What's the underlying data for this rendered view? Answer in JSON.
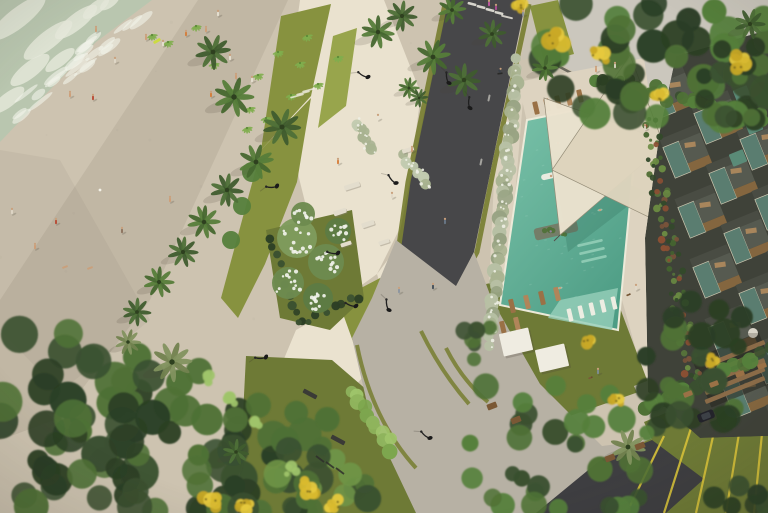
{
  "meta": {
    "title": "Aerial architectural rendering of a beachfront resort: beach with people, landscaped promenade with palms, road, swimming pool deck with shade sails and loungers, residential building with stepped balconies",
    "width": 768,
    "height": 513
  },
  "palette": {
    "sand": "#cdc3b0",
    "sandLight": "#d7cdbb",
    "shadow": "#6e6453",
    "sea": "#b7c6af",
    "foam": "#e6e9db",
    "plaza": "#eae2cf",
    "deck": "#ddd3c0",
    "concrete": "#b7b1a4",
    "gray": "#c9c2b3",
    "asphalt": "#474749",
    "asphaltB": "#3e3e41",
    "olive": "#7a8136",
    "lawn": "#87923f",
    "lawnBright": "#98a54c",
    "lawnDark": "#6e7a36",
    "leaf": "#4f7136",
    "leafLight": "#6f9447",
    "leafPale": "#9fc46a",
    "canopy": "#3a5030",
    "canopyDark": "#2c3f25",
    "yellow": "#d9ba2f",
    "white": "#f1eee4",
    "pool": "#7cc4ab",
    "poolDeep": "#4e9d85",
    "ledge": "#97d0ba",
    "sail": "#ece3cf",
    "sail2": "#ded4bd",
    "wood": "#9a7146",
    "woodDark": "#7a5835",
    "glass": "#5c8173",
    "slab": "#3f4239",
    "frame": "#d6d0b8",
    "hedge": "#a9b391",
    "hedgeDot": "#eef0e4",
    "skin": "#c9a07c",
    "lamp": "#1c1c1c",
    "roof": "#cbc7bd",
    "yellowLine": "#d8c23a"
  },
  "sea": {
    "poly": "0,0 152,0 96,42 44,96 0,142",
    "foam": [
      [
        18,
        18,
        34,
        10
      ],
      [
        48,
        40,
        30,
        9
      ],
      [
        76,
        22,
        26,
        8
      ],
      [
        30,
        70,
        24,
        8
      ],
      [
        8,
        100,
        20,
        7
      ],
      [
        60,
        60,
        18,
        6
      ],
      [
        96,
        8,
        16,
        6
      ],
      [
        110,
        2,
        12,
        5
      ]
    ]
  },
  "shadows": [
    {
      "p": "198,0 288,0 150,300 60,418 0,440 0,300",
      "o": 0.12
    },
    {
      "p": "0,150 60,160 150,320 60,392 0,330",
      "o": 0.08
    }
  ],
  "roof": {
    "p": "556,0 768,0 768,98 746,120 650,116 560,64",
    "parapet": "558,66 648,114 746,118 768,96"
  },
  "plaza": [
    {
      "p": "300,0 384,0 421,94 412,160 404,220 377,274 341,300 317,250 299,178 287,94",
      "f": "plaza"
    },
    {
      "p": "377,274 406,236 420,280 412,296 384,298",
      "f": "plaza"
    },
    {
      "p": "296,330 344,304 384,298 404,320 382,356 344,398 330,444 318,513 246,513 258,436 276,378",
      "f": "plaza"
    },
    {
      "p": "528,0 556,0 546,54 522,60",
      "f": "gray"
    },
    {
      "p": "518,82 644,58 650,100 527,122",
      "f": "deck"
    },
    {
      "p": "498,96 524,88 506,304 488,308",
      "f": "deck"
    },
    {
      "p": "636,94 668,88 698,384 650,400 622,300 630,180",
      "f": "deck"
    }
  ],
  "lawns": [
    {
      "p": "281,16 331,4 311,96 261,150",
      "f": "lawn"
    },
    {
      "p": "261,150 311,98 297,182 265,264 238,318 221,298",
      "f": "lawn"
    },
    {
      "p": "333,36 357,28 346,106 318,128",
      "f": "lawnBright"
    },
    {
      "p": "530,6 558,0 574,54 544,62",
      "f": "lawn"
    },
    {
      "p": "486,284 602,260 650,388 518,434",
      "f": "lawnDark"
    },
    {
      "p": "246,356 332,360 404,422 470,500 470,513 238,513",
      "f": "lawnDark"
    },
    {
      "p": "338,300 384,276 400,250 436,330 462,410 442,450 398,406 356,350",
      "f": "lawn"
    },
    {
      "p": "266,230 352,210 364,298 330,330 280,318",
      "f": "lawnDark"
    }
  ],
  "roads": {
    "asphalt": "448,0 526,0 492,164 474,252 456,288 410,294 396,252 410,180",
    "stripL": "445,4 408,182 398,252 408,290",
    "stripR": "529,4 495,162 477,252 458,288",
    "crosswalk": [
      [
        472,
        4
      ],
      [
        481,
        7
      ],
      [
        490,
        10
      ],
      [
        499,
        13
      ]
    ],
    "stopline": [
      507,
      17
    ],
    "dashes": [
      [
        497,
        32
      ],
      [
        489,
        98
      ],
      [
        481,
        162
      ]
    ],
    "junction": "396,240 456,286 474,252 492,300 540,384 602,446 650,440 600,462 540,513 416,513 370,416 352,338 372,298",
    "arcs": [
      "M446,348 Q462,380 488,402",
      "M421,331 Q441,372 469,404",
      "M357,345 Q372,420 416,468"
    ],
    "curb": "M600,462 L652,440",
    "asphaltB": "536,513 598,462 652,440 704,479 666,513",
    "parkSide": "634,386 768,334 768,366 648,418",
    "parkGreen": "644,422 768,370 768,513 664,513 652,440",
    "yellowLines": [
      [
        664,
        436,
        630,
        506
      ],
      [
        692,
        425,
        664,
        513
      ],
      [
        718,
        414,
        696,
        513
      ],
      [
        744,
        403,
        726,
        513
      ],
      [
        766,
        394,
        754,
        513
      ]
    ],
    "glyph": [
      [
        748,
        398,
        756,
        396
      ],
      [
        750,
        403,
        758,
        401
      ]
    ]
  },
  "pool": {
    "quad": "527,120 640,97 618,330 500,305",
    "ledge": "560,300 618,288 612,330 548,318",
    "steps": [
      [
        590,
        243
      ],
      [
        592,
        251
      ],
      [
        594,
        259
      ]
    ],
    "planters": [
      [
        570,
        162,
        36,
        11
      ],
      [
        556,
        230,
        44,
        12
      ]
    ],
    "swimmers": [
      [
        558,
        143
      ],
      [
        600,
        210
      ],
      [
        560,
        288
      ],
      [
        592,
        128
      ]
    ],
    "float": [
      549,
      176
    ],
    "sailShadow": "552,150 646,192 568,252",
    "inpool": [
      [
        570,
        315
      ],
      [
        581,
        312
      ],
      [
        592,
        309
      ],
      [
        603,
        306
      ],
      [
        614,
        303
      ]
    ],
    "topLoungers": [
      [
        536,
        108
      ],
      [
        547,
        105
      ],
      [
        558,
        102
      ],
      [
        569,
        99
      ],
      [
        580,
        96
      ]
    ],
    "southLoungers": [
      [
        512,
        306
      ],
      [
        527,
        302
      ],
      [
        542,
        298
      ],
      [
        557,
        294
      ],
      [
        503,
        328
      ],
      [
        517,
        324
      ]
    ],
    "daybeds": [
      [
        516,
        342
      ],
      [
        552,
        358
      ]
    ],
    "sails": [
      {
        "p": "544,98 668,142 560,235",
        "f": "sail"
      },
      {
        "p": "630,55 700,242 552,170",
        "f": "sail2"
      }
    ],
    "poleLines": [
      "M668,142 L676,136",
      "M560,235 L554,241",
      "M700,242 L708,238"
    ]
  },
  "building": {
    "clip": "676,56 768,30 768,436 700,438 648,392 645,238 660,130",
    "grid": {
      "x0": 652,
      "y0": 70,
      "cols": 3,
      "rows": 6,
      "cx": 46,
      "cy": 26,
      "rx": 15,
      "ry": 60,
      "rot": -22
    },
    "cubes": [
      [
        742,
        94
      ],
      [
        754,
        126
      ],
      [
        738,
        158
      ]
    ],
    "pergola": {
      "x": 698,
      "y": 342,
      "w": 72,
      "h": 52,
      "slats": 5,
      "rot": -22,
      "cx": 735,
      "cy": 370
    },
    "dome": [
      753,
      333
    ]
  },
  "gardenStrips": [
    {
      "x1": 648,
      "y1": 122,
      "x2": 692,
      "y2": 378,
      "n": 85,
      "r0": 1.5,
      "r1": 4,
      "jit": 9,
      "pal": [
        "#44632f",
        "#33492a",
        "#6a8a42",
        "#77523a",
        "#8a4f33",
        "#55713a"
      ]
    },
    {
      "x1": 600,
      "y1": 80,
      "x2": 764,
      "y2": 116,
      "n": 34,
      "r0": 3,
      "r1": 8,
      "jit": 7,
      "pal": [
        "#3a5030",
        "#4f7136",
        "#2c3f25",
        "#55803c"
      ]
    },
    {
      "x1": 644,
      "y1": 404,
      "x2": 768,
      "y2": 352,
      "n": 16,
      "r0": 5,
      "r1": 9,
      "jit": 5,
      "pal": [
        "#3a5030",
        "#4f7136",
        "#55803c"
      ]
    }
  ],
  "hedges": [
    {
      "x1": 517,
      "y1": 60,
      "x2": 489,
      "y2": 344,
      "n": 46,
      "r0": 5,
      "r1": 8,
      "jit": 3,
      "pal": [
        "#a9b391",
        "#98a383",
        "#b7c0a4"
      ],
      "dots": 40
    },
    {
      "x1": 355,
      "y1": 122,
      "x2": 372,
      "y2": 148,
      "n": 8,
      "r0": 4,
      "r1": 6,
      "jit": 3,
      "pal": [
        "#c2cbb0",
        "#a9b391"
      ],
      "dots": 10
    },
    {
      "x1": 402,
      "y1": 156,
      "x2": 428,
      "y2": 184,
      "n": 9,
      "r0": 4,
      "r1": 6,
      "jit": 3,
      "pal": [
        "#c2cbb0",
        "#a9b391"
      ],
      "dots": 10
    },
    {
      "x1": 352,
      "y1": 390,
      "x2": 392,
      "y2": 448,
      "n": 11,
      "r0": 5.5,
      "r1": 8,
      "jit": 4,
      "pal": [
        "#9fc46a",
        "#8fb45d",
        "#7da64e"
      ],
      "dots": 0
    },
    {
      "x1": 268,
      "y1": 236,
      "x2": 300,
      "y2": 324,
      "n": 10,
      "r0": 3,
      "r1": 5,
      "jit": 3,
      "pal": [
        "#2c3f25",
        "#3a5030"
      ],
      "dots": 0
    },
    {
      "x1": 300,
      "y1": 324,
      "x2": 358,
      "y2": 296,
      "n": 8,
      "r0": 3,
      "r1": 5,
      "jit": 3,
      "pal": [
        "#2c3f25",
        "#3a5030"
      ],
      "dots": 0
    }
  ],
  "canopies": [
    {
      "x": 545,
      "y": 0,
      "w": 223,
      "h": 118,
      "n": 48,
      "r0": 9,
      "r1": 18,
      "pal": [
        "canopy",
        "leaf",
        "canopyDark",
        "#55803c"
      ]
    },
    {
      "x": 700,
      "y": 36,
      "w": 68,
      "h": 84,
      "n": 12,
      "r0": 7,
      "r1": 12,
      "pal": [
        "canopy",
        "leaf",
        "canopyDark"
      ]
    },
    {
      "x": 0,
      "y": 328,
      "w": 140,
      "h": 185,
      "n": 30,
      "r0": 10,
      "r1": 20,
      "pal": [
        "canopy",
        "canopyDark",
        "leaf"
      ]
    },
    {
      "x": 70,
      "y": 356,
      "w": 170,
      "h": 157,
      "n": 34,
      "r0": 10,
      "r1": 19,
      "pal": [
        "canopy",
        "canopyDark",
        "leaf"
      ]
    },
    {
      "x": 190,
      "y": 402,
      "w": 140,
      "h": 111,
      "n": 24,
      "r0": 9,
      "r1": 17,
      "pal": [
        "canopy",
        "canopyDark",
        "leaf"
      ]
    },
    {
      "x": 276,
      "y": 448,
      "w": 92,
      "h": 65,
      "n": 14,
      "r0": 8,
      "r1": 14,
      "pal": [
        "canopy",
        "leaf",
        "leafLight"
      ]
    },
    {
      "x": 458,
      "y": 382,
      "w": 200,
      "h": 128,
      "n": 34,
      "r0": 7,
      "r1": 14,
      "pal": [
        "leaf",
        "canopy",
        "#55803c"
      ]
    },
    {
      "x": 714,
      "y": 482,
      "w": 54,
      "h": 31,
      "n": 7,
      "r0": 7,
      "r1": 12,
      "pal": [
        "canopy",
        "canopyDark"
      ]
    },
    {
      "x": 464,
      "y": 306,
      "w": 26,
      "h": 62,
      "n": 6,
      "r0": 6,
      "r1": 9,
      "pal": [
        "leaf",
        "canopy"
      ]
    }
  ],
  "pergolaCanopy": {
    "x": 640,
    "y": 298,
    "w": 104,
    "h": 122,
    "n": 22,
    "r0": 8,
    "r1": 15,
    "pal": [
      "canopy",
      "leaf",
      "canopyDark"
    ]
  },
  "yellowTrees": [
    [
      552,
      38,
      13
    ],
    [
      598,
      55,
      10
    ],
    [
      738,
      62,
      10
    ],
    [
      660,
      96,
      7
    ],
    [
      210,
      500,
      10
    ],
    [
      308,
      487,
      9
    ],
    [
      244,
      506,
      8
    ],
    [
      334,
      505,
      7
    ],
    [
      588,
      342,
      7
    ],
    [
      616,
      400,
      6
    ],
    [
      712,
      360,
      5
    ],
    [
      520,
      6,
      6
    ]
  ],
  "paleBushes": [
    [
      232,
      398,
      9
    ],
    [
      256,
      420,
      8
    ],
    [
      292,
      470,
      8
    ],
    [
      206,
      380,
      7
    ]
  ],
  "whiteTrees": [
    [
      297,
      238,
      20
    ],
    [
      326,
      262,
      18
    ],
    [
      288,
      283,
      16
    ],
    [
      318,
      298,
      15
    ],
    [
      338,
      231,
      13
    ],
    [
      303,
      214,
      12
    ]
  ],
  "smallTrees": [
    [
      252,
      172,
      10
    ],
    [
      242,
      206,
      9
    ],
    [
      231,
      240,
      9
    ]
  ],
  "shrubs": [
    [
      258,
      75
    ],
    [
      278,
      52
    ],
    [
      300,
      63
    ],
    [
      318,
      84
    ],
    [
      291,
      95
    ],
    [
      307,
      36
    ],
    [
      338,
      57
    ],
    [
      250,
      108
    ],
    [
      231,
      90
    ],
    [
      214,
      64
    ],
    [
      152,
      35
    ],
    [
      168,
      42
    ],
    [
      196,
      26
    ],
    [
      247,
      128
    ],
    [
      266,
      118
    ]
  ],
  "palms": [
    [
      213,
      52,
      15,
      0
    ],
    [
      234,
      97,
      17,
      1
    ],
    [
      282,
      127,
      16,
      0
    ],
    [
      256,
      162,
      15,
      1
    ],
    [
      227,
      190,
      14,
      0
    ],
    [
      204,
      222,
      14,
      1
    ],
    [
      183,
      252,
      13,
      0
    ],
    [
      159,
      282,
      13,
      1
    ],
    [
      137,
      312,
      12,
      0
    ],
    [
      378,
      32,
      14,
      1
    ],
    [
      402,
      16,
      13,
      0
    ],
    [
      433,
      57,
      15,
      1
    ],
    [
      464,
      80,
      14,
      0
    ],
    [
      452,
      10,
      12,
      1
    ],
    [
      492,
      34,
      12,
      0
    ],
    [
      545,
      68,
      11,
      1
    ],
    [
      409,
      88,
      9,
      1
    ],
    [
      419,
      98,
      8,
      0
    ],
    [
      750,
      24,
      13,
      0
    ],
    [
      628,
      447,
      15,
      2
    ],
    [
      172,
      362,
      17,
      2
    ],
    [
      128,
      342,
      11,
      2
    ],
    [
      236,
      452,
      11,
      0
    ]
  ],
  "furniture": {
    "skate": [
      [
        352,
        186,
        16,
        5
      ],
      [
        340,
        212,
        13,
        5
      ],
      [
        368,
        224,
        13,
        5
      ],
      [
        346,
        244,
        11,
        4
      ],
      [
        384,
        242,
        11,
        4
      ],
      [
        408,
        150,
        12,
        4
      ]
    ],
    "benches": [
      [
        310,
        394,
        15,
        4.5
      ],
      [
        338,
        440,
        15,
        4.5
      ]
    ],
    "steps": [
      [
        297,
        96
      ],
      [
        303,
        93
      ],
      [
        309,
        90
      ]
    ],
    "parkPlanters": [
      [
        688,
        394
      ],
      [
        714,
        384
      ],
      [
        740,
        374
      ],
      [
        762,
        366
      ]
    ],
    "gardenPlanters": [
      [
        492,
        406
      ],
      [
        516,
        420
      ],
      [
        610,
        458
      ],
      [
        640,
        446
      ]
    ],
    "bikes": [
      [
        316,
        456,
        324,
        462
      ],
      [
        326,
        462,
        334,
        468
      ],
      [
        336,
        468,
        344,
        474
      ]
    ],
    "surfboard": [
      157,
      41
    ]
  },
  "lamps": [
    [
      368,
      77,
      150
    ],
    [
      449,
      83,
      200
    ],
    [
      470,
      108,
      210
    ],
    [
      277,
      186,
      120
    ],
    [
      396,
      183,
      170
    ],
    [
      356,
      306,
      140
    ],
    [
      389,
      310,
      200
    ],
    [
      266,
      357,
      120
    ],
    [
      430,
      438,
      160
    ],
    [
      338,
      253,
      130
    ]
  ],
  "car": [
    706,
    416
  ],
  "figures": {
    "beach": [
      [
        218,
        14,
        "#e8e2d4"
      ],
      [
        206,
        30,
        "#cf9c74"
      ],
      [
        186,
        34,
        "#d57a35"
      ],
      [
        146,
        38,
        "#cf9c74"
      ],
      [
        163,
        44,
        "#e8e2d4"
      ],
      [
        70,
        95,
        "#cf9c74"
      ],
      [
        93,
        98,
        "#b8452f"
      ],
      [
        115,
        61,
        "#e0d8c8"
      ],
      [
        236,
        77,
        "#cf9c74"
      ],
      [
        252,
        80,
        "#e8e2d4"
      ],
      [
        211,
        95,
        "#d57a35"
      ],
      [
        56,
        222,
        "#b8452f"
      ],
      [
        170,
        200,
        "#cf9c74"
      ],
      [
        35,
        247,
        "#cf9c74"
      ],
      [
        122,
        231,
        "#8a6f5a"
      ],
      [
        12,
        212,
        "#e0d8c8"
      ],
      [
        230,
        58,
        "#e8e2d4"
      ],
      [
        96,
        30,
        "#cf9c74"
      ]
    ],
    "lying": [
      [
        65,
        267
      ],
      [
        90,
        268
      ]
    ],
    "walkers": [
      [
        489,
        4,
        "#c959a8"
      ],
      [
        496,
        8,
        "#b44f98"
      ],
      [
        523,
        14,
        "#8d949c"
      ],
      [
        392,
        196,
        "#e0d8c8"
      ],
      [
        399,
        291,
        "#8a94a0"
      ],
      [
        433,
        287,
        "#3f4a55"
      ],
      [
        412,
        150,
        "#cf9c74"
      ],
      [
        378,
        118,
        "#e8e2d4"
      ],
      [
        445,
        222,
        "#6b7a8a"
      ],
      [
        338,
        162,
        "#d57a35"
      ],
      [
        598,
        372,
        "#7f8f9a"
      ],
      [
        636,
        288,
        "#e0d8c8"
      ],
      [
        645,
        128,
        "#e0d8c8"
      ],
      [
        596,
        70,
        "#cf9c74"
      ],
      [
        615,
        66,
        "#e0d8c8"
      ]
    ],
    "dogs": [
      [
        590,
        378
      ],
      [
        628,
        295
      ]
    ],
    "cyclist": [
      500,
      72
    ],
    "bird": [
      100,
      190
    ]
  }
}
